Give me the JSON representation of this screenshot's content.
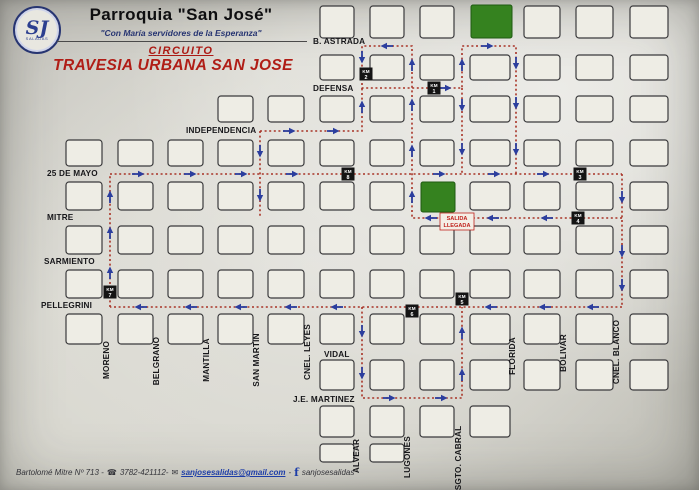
{
  "header": {
    "title": "Parroquia \"San José\"",
    "subtitle": "\"Con María servidores de la Esperanza\"",
    "circuit_label": "CIRCUITO",
    "route_title": "TRAVESIA URBANA SAN JOSE",
    "logo_monogram": "SJ",
    "logo_subtext": "SALADAS"
  },
  "footer": {
    "address": "Bartolomé Mitre Nº 713 -",
    "phone_icon": "☎",
    "phone": "3782-421112-",
    "email_icon": "✉",
    "email": "sanjosesalidas@gmail.com",
    "separator": "-",
    "facebook_icon": "f",
    "facebook": "sanjosesalidas"
  },
  "colors": {
    "route": "#a83326",
    "arrow": "#2b3e9e",
    "km_bg": "#141414",
    "km_text": "#ffffff",
    "green_block": "#35821f",
    "green_border": "#1e5a12",
    "salida_red": "#c0231d",
    "street_text": "#17171a",
    "block_border": "#3a3a3c",
    "block_fill": "#eeede5"
  },
  "map": {
    "km_label": "KM",
    "h_streets": [
      {
        "name": "B. ASTRADA",
        "x": 313,
        "y": 41
      },
      {
        "name": "DEFENSA",
        "x": 313,
        "y": 88
      },
      {
        "name": "INDEPENDENCIA",
        "x": 186,
        "y": 130
      },
      {
        "name": "25 DE MAYO",
        "x": 47,
        "y": 173
      },
      {
        "name": "MITRE",
        "x": 47,
        "y": 217
      },
      {
        "name": "SARMIENTO",
        "x": 44,
        "y": 261
      },
      {
        "name": "PELLEGRINI",
        "x": 41,
        "y": 305
      },
      {
        "name": "VIDAL",
        "x": 324,
        "y": 354
      },
      {
        "name": "J.E. MARTINEZ",
        "x": 293,
        "y": 399
      }
    ],
    "v_streets": [
      {
        "name": "MORENO",
        "x": 109,
        "y": 360
      },
      {
        "name": "BELGRANO",
        "x": 159,
        "y": 361
      },
      {
        "name": "MANTILLA",
        "x": 209,
        "y": 360
      },
      {
        "name": "SAN MARTIN",
        "x": 259,
        "y": 360
      },
      {
        "name": "CNEL. LEYES",
        "x": 310,
        "y": 352
      },
      {
        "name": "ALVEAR",
        "x": 359,
        "y": 456
      },
      {
        "name": "LUGONES",
        "x": 410,
        "y": 457
      },
      {
        "name": "SGTO. CABRAL",
        "x": 461,
        "y": 458
      },
      {
        "name": "FLORIDA",
        "x": 515,
        "y": 356
      },
      {
        "name": "BOLIVAR",
        "x": 566,
        "y": 353
      },
      {
        "name": "CNEL. BLANCO",
        "x": 619,
        "y": 352
      }
    ],
    "grid": {
      "cols": [
        [
          66,
          36
        ],
        [
          118,
          35
        ],
        [
          168,
          35
        ],
        [
          218,
          35
        ],
        [
          268,
          36
        ],
        [
          320,
          34
        ],
        [
          370,
          34
        ],
        [
          420,
          34
        ],
        [
          470,
          40
        ],
        [
          524,
          36
        ],
        [
          576,
          37
        ],
        [
          630,
          38
        ]
      ],
      "rows": [
        [
          6,
          32
        ],
        [
          55,
          25
        ],
        [
          96,
          26
        ],
        [
          140,
          26
        ],
        [
          182,
          28
        ],
        [
          226,
          28
        ],
        [
          270,
          28
        ],
        [
          314,
          30
        ],
        [
          360,
          30
        ],
        [
          406,
          31
        ],
        [
          444,
          18
        ]
      ],
      "cells": [
        [
          0,
          [
            5,
            6,
            7,
            9,
            10,
            11
          ]
        ],
        [
          1,
          [
            5,
            6,
            7,
            8,
            9,
            10,
            11
          ]
        ],
        [
          2,
          [
            3,
            4,
            5,
            6,
            7,
            8,
            9,
            10,
            11
          ]
        ],
        [
          3,
          [
            0,
            1,
            2,
            3,
            4,
            5,
            6,
            7,
            8,
            9,
            10,
            11
          ]
        ],
        [
          4,
          [
            0,
            1,
            2,
            3,
            4,
            5,
            6,
            8,
            9,
            10,
            11
          ]
        ],
        [
          5,
          [
            0,
            1,
            2,
            3,
            4,
            5,
            6,
            7,
            8,
            9,
            10,
            11
          ]
        ],
        [
          6,
          [
            0,
            1,
            2,
            3,
            4,
            5,
            6,
            7,
            8,
            9,
            10,
            11
          ]
        ],
        [
          7,
          [
            0,
            1,
            2,
            3,
            4,
            5,
            6,
            7,
            8,
            9,
            10,
            11
          ]
        ],
        [
          8,
          [
            5,
            6,
            7,
            8,
            9,
            10,
            11
          ]
        ],
        [
          9,
          [
            5,
            6,
            7,
            8
          ]
        ],
        [
          10,
          [
            5,
            6
          ]
        ]
      ]
    },
    "green_blocks": [
      {
        "x": 471,
        "y": 5,
        "w": 41,
        "h": 33
      },
      {
        "x": 421,
        "y": 182,
        "w": 34,
        "h": 30
      }
    ],
    "start_box": {
      "lines": [
        "SALIDA",
        "LLEGADA"
      ],
      "x": 440,
      "y": 213,
      "w": 34,
      "h": 17
    },
    "route_segments": [
      {
        "pts": [
          [
            110,
            307
          ],
          [
            110,
            174
          ]
        ]
      },
      {
        "pts": [
          [
            110,
            174
          ],
          [
            622,
            174
          ]
        ]
      },
      {
        "pts": [
          [
            622,
            174
          ],
          [
            622,
            307
          ]
        ]
      },
      {
        "pts": [
          [
            622,
            307
          ],
          [
            110,
            307
          ]
        ]
      },
      {
        "pts": [
          [
            622,
            218
          ],
          [
            452,
            218
          ]
        ]
      },
      {
        "pts": [
          [
            452,
            218
          ],
          [
            412,
            218
          ],
          [
            412,
            46
          ],
          [
            362,
            46
          ],
          [
            362,
            88
          ],
          [
            462,
            88
          ],
          [
            462,
            46
          ],
          [
            516,
            46
          ],
          [
            516,
            174
          ]
        ]
      },
      {
        "pts": [
          [
            260,
            131
          ],
          [
            362,
            131
          ],
          [
            362,
            88
          ]
        ]
      },
      {
        "pts": [
          [
            260,
            131
          ],
          [
            260,
            218
          ]
        ]
      },
      {
        "pts": [
          [
            462,
            88
          ],
          [
            462,
            174
          ]
        ]
      },
      {
        "pts": [
          [
            362,
            307
          ],
          [
            362,
            398
          ],
          [
            462,
            398
          ],
          [
            462,
            307
          ]
        ]
      }
    ],
    "arrows": [
      [
        110,
        272,
        "up"
      ],
      [
        110,
        232,
        "up"
      ],
      [
        110,
        196,
        "up"
      ],
      [
        139,
        174,
        "right"
      ],
      [
        191,
        174,
        "right"
      ],
      [
        242,
        174,
        "right"
      ],
      [
        293,
        174,
        "right"
      ],
      [
        440,
        174,
        "right"
      ],
      [
        495,
        174,
        "right"
      ],
      [
        544,
        174,
        "right"
      ],
      [
        622,
        198,
        "down"
      ],
      [
        622,
        252,
        "down"
      ],
      [
        622,
        286,
        "down"
      ],
      [
        592,
        307,
        "left"
      ],
      [
        544,
        307,
        "left"
      ],
      [
        490,
        307,
        "left"
      ],
      [
        336,
        307,
        "left"
      ],
      [
        290,
        307,
        "left"
      ],
      [
        240,
        307,
        "left"
      ],
      [
        190,
        307,
        "left"
      ],
      [
        140,
        307,
        "left"
      ],
      [
        546,
        218,
        "left"
      ],
      [
        492,
        218,
        "left"
      ],
      [
        430,
        218,
        "left"
      ],
      [
        412,
        196,
        "up"
      ],
      [
        412,
        150,
        "up"
      ],
      [
        412,
        104,
        "up"
      ],
      [
        412,
        64,
        "up"
      ],
      [
        386,
        46,
        "left"
      ],
      [
        362,
        58,
        "down"
      ],
      [
        446,
        88,
        "right"
      ],
      [
        462,
        64,
        "up"
      ],
      [
        488,
        46,
        "right"
      ],
      [
        516,
        64,
        "down"
      ],
      [
        516,
        104,
        "down"
      ],
      [
        516,
        150,
        "down"
      ],
      [
        290,
        131,
        "right"
      ],
      [
        334,
        131,
        "right"
      ],
      [
        362,
        106,
        "up"
      ],
      [
        260,
        152,
        "down"
      ],
      [
        260,
        196,
        "down"
      ],
      [
        462,
        106,
        "down"
      ],
      [
        462,
        150,
        "down"
      ],
      [
        362,
        332,
        "down"
      ],
      [
        362,
        374,
        "down"
      ],
      [
        390,
        398,
        "right"
      ],
      [
        442,
        398,
        "right"
      ],
      [
        462,
        374,
        "up"
      ],
      [
        462,
        332,
        "up"
      ]
    ],
    "km_markers": [
      {
        "num": "1",
        "x": 434,
        "y": 88
      },
      {
        "num": "2",
        "x": 366,
        "y": 74
      },
      {
        "num": "3",
        "x": 580,
        "y": 174
      },
      {
        "num": "4",
        "x": 578,
        "y": 218
      },
      {
        "num": "5",
        "x": 462,
        "y": 299
      },
      {
        "num": "6",
        "x": 412,
        "y": 311
      },
      {
        "num": "7",
        "x": 110,
        "y": 292
      },
      {
        "num": "8",
        "x": 348,
        "y": 174
      }
    ]
  }
}
